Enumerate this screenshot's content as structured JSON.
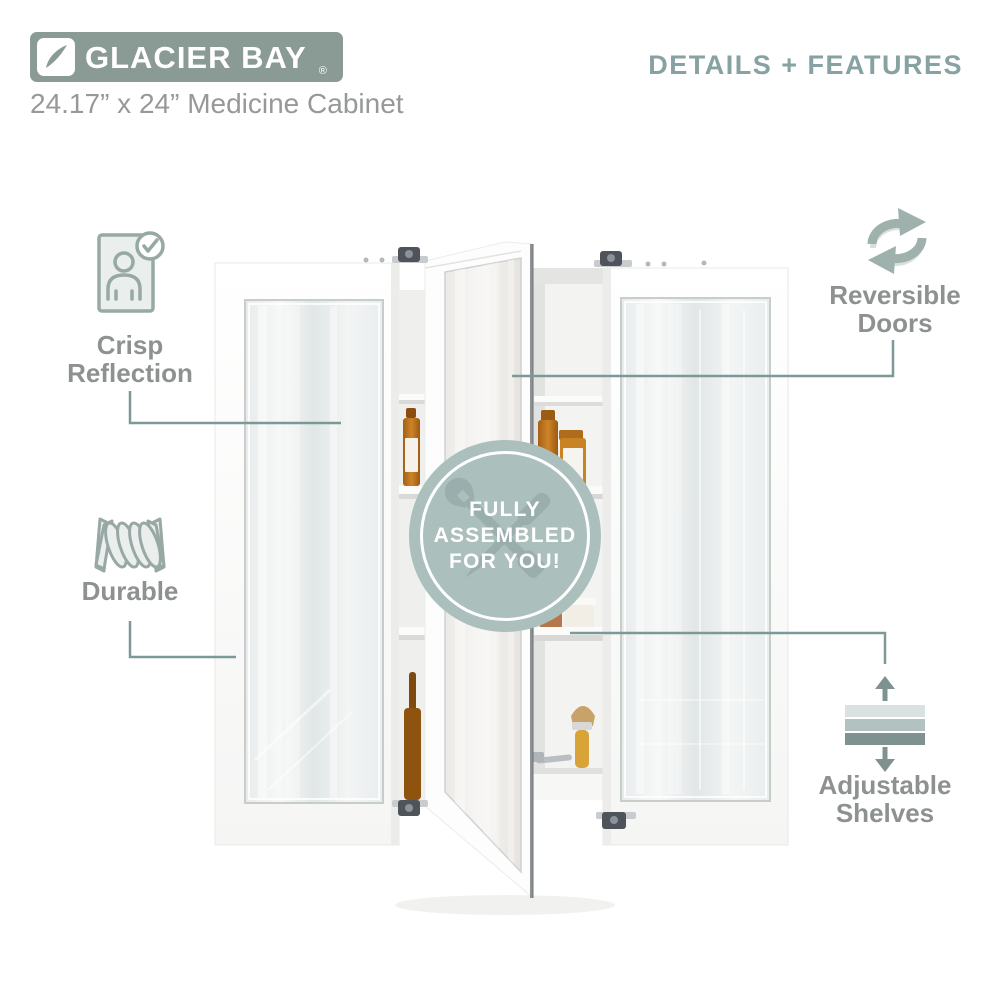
{
  "brand": {
    "name": "GLACIER BAY",
    "registered_mark": "®"
  },
  "product": {
    "title": "24.17” x 24” Medicine Cabinet"
  },
  "section": {
    "title": "DETAILS + FEATURES"
  },
  "badge": {
    "line1": "FULLY",
    "line2": "ASSEMBLED",
    "line3": "FOR YOU!",
    "watermark": "crossed-tools"
  },
  "features": {
    "crisp_reflection": {
      "line1": "Crisp",
      "line2": "Reflection",
      "icon": "mirror-person-check-icon"
    },
    "durable": {
      "line1": "Durable",
      "icon": "coil-spring-icon"
    },
    "reversible_doors": {
      "line1": "Reversible",
      "line2": "Doors",
      "icon": "rotation-arrows-icon"
    },
    "adjustable_shelves": {
      "line1": "Adjustable",
      "line2": "Shelves",
      "icon": "shelves-arrows-icon"
    }
  },
  "colors": {
    "logo_bg": "#8a9a95",
    "heading_teal": "#86a2a2",
    "label_gray": "#8d9190",
    "connector_line": "#7d9997",
    "badge_bg": "#abbfbd",
    "title_gray": "#96989a",
    "icon_stroke": "#97a8a5",
    "icon_fill": "#eaefee"
  }
}
